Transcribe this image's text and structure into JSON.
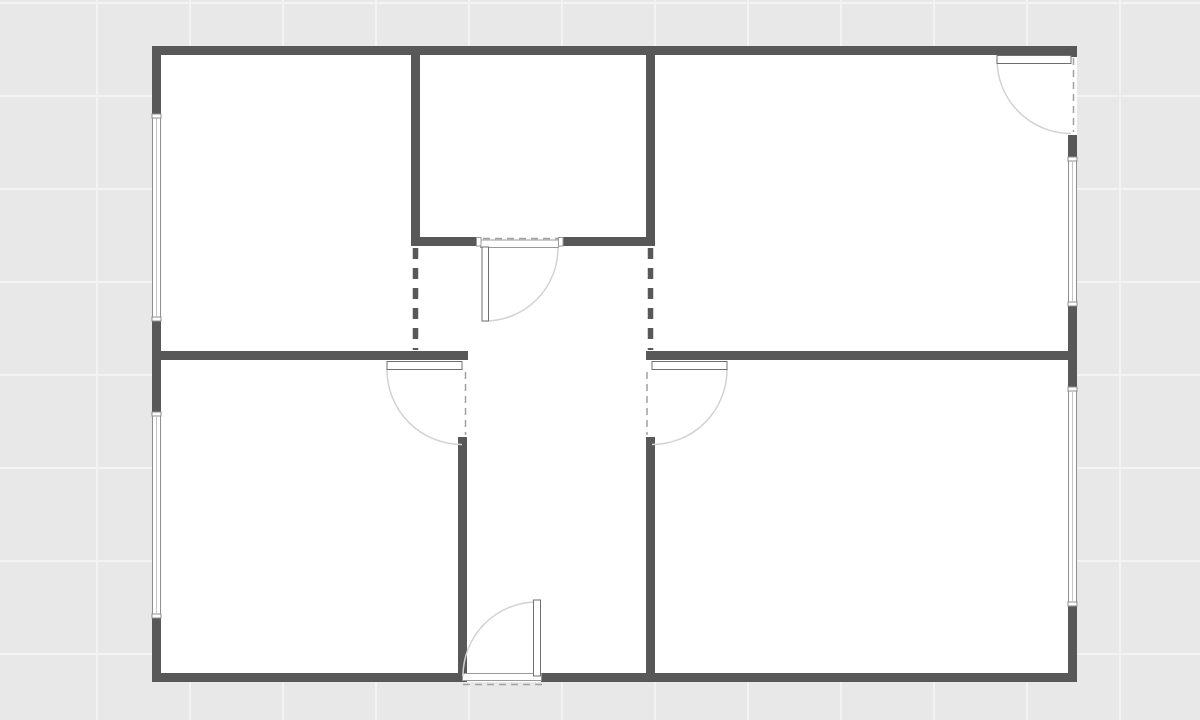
{
  "app": {
    "type": "floorplan-canvas",
    "title": "Floor plan canvas"
  },
  "canvas": {
    "width": 1200,
    "height": 720,
    "background": "#e8e8e8",
    "grid": {
      "spacing": 93,
      "offset_x": 97,
      "offset_y": 3,
      "color": "#f3f3f3",
      "line_width": 2
    }
  },
  "palette": {
    "wall": "#585858",
    "floor": "#ffffff",
    "window_stroke": "#8f8f8f",
    "window_glass": "#c4c4c4",
    "frame_stroke": "#9a9a9a",
    "leaf_fill": "#ffffff",
    "leaf_stroke": "#6f6f6f",
    "arc": "#d2d2d2",
    "dash_light": "#a0a0a0",
    "dash_heavy": "#585858"
  },
  "floorplan": {
    "floor": {
      "x": 152,
      "y": 46,
      "w": 925,
      "h": 636
    },
    "walls": [
      {
        "name": "exterior-top",
        "x": 152,
        "y": 46,
        "w": 925,
        "h": 9
      },
      {
        "name": "exterior-bottom-left",
        "x": 152,
        "y": 673,
        "w": 315,
        "h": 9
      },
      {
        "name": "exterior-bottom-right",
        "x": 541,
        "y": 673,
        "w": 536,
        "h": 9
      },
      {
        "name": "exterior-left-upper",
        "x": 152,
        "y": 46,
        "w": 9,
        "h": 69
      },
      {
        "name": "exterior-left-middle",
        "x": 152,
        "y": 320,
        "w": 9,
        "h": 93
      },
      {
        "name": "exterior-left-lower",
        "x": 152,
        "y": 617,
        "w": 9,
        "h": 65
      },
      {
        "name": "exterior-right-stub",
        "x": 1068,
        "y": 46,
        "w": 9,
        "h": 11
      },
      {
        "name": "exterior-right-upper",
        "x": 1068,
        "y": 135,
        "w": 9,
        "h": 23
      },
      {
        "name": "exterior-right-middle",
        "x": 1068,
        "y": 305,
        "w": 9,
        "h": 83
      },
      {
        "name": "exterior-right-lower",
        "x": 1068,
        "y": 605,
        "w": 9,
        "h": 77
      },
      {
        "name": "top-room-left",
        "x": 411,
        "y": 55,
        "w": 9,
        "h": 190
      },
      {
        "name": "top-room-right",
        "x": 646,
        "y": 55,
        "w": 9,
        "h": 190
      },
      {
        "name": "top-room-bottom-left",
        "x": 411,
        "y": 237,
        "w": 70,
        "h": 9
      },
      {
        "name": "top-room-bottom-right",
        "x": 562,
        "y": 237,
        "w": 93,
        "h": 9
      },
      {
        "name": "mid-wall-left",
        "x": 152,
        "y": 351,
        "w": 316,
        "h": 9
      },
      {
        "name": "mid-wall-right",
        "x": 646,
        "y": 351,
        "w": 422,
        "h": 9
      },
      {
        "name": "hallway-left",
        "x": 458,
        "y": 437,
        "w": 9,
        "h": 236
      },
      {
        "name": "hallway-right",
        "x": 646,
        "y": 437,
        "w": 9,
        "h": 236
      }
    ],
    "windows": [
      {
        "name": "window-left-upper",
        "x": 152.5,
        "y": 115,
        "w": 8,
        "h": 205
      },
      {
        "name": "window-left-lower",
        "x": 152.5,
        "y": 413,
        "w": 8,
        "h": 204
      },
      {
        "name": "window-right-upper",
        "x": 1068.5,
        "y": 158,
        "w": 8,
        "h": 147
      },
      {
        "name": "window-right-lower",
        "x": 1068.5,
        "y": 388,
        "w": 8,
        "h": 217
      }
    ],
    "sills": [
      {
        "name": "sill-top-room-door",
        "x": 480.5,
        "y": 240,
        "w": 78,
        "h": 7.5
      },
      {
        "name": "sill-entry-door",
        "x": 462.5,
        "y": 673.5,
        "w": 79,
        "h": 7
      }
    ],
    "jambs": [
      {
        "name": "jamb-top-room-left",
        "x": 476.5,
        "y": 237.5,
        "w": 4.5,
        "h": 8.5
      },
      {
        "name": "jamb-top-room-right",
        "x": 558.5,
        "y": 237.5,
        "w": 4.5,
        "h": 8.5
      }
    ],
    "door_leaves": [
      {
        "name": "door-leaf-top-room",
        "x": 482,
        "y": 247,
        "w": 6.5,
        "h": 74
      },
      {
        "name": "door-leaf-left-room",
        "x": 387,
        "y": 361.5,
        "w": 75,
        "h": 8
      },
      {
        "name": "door-leaf-right-room",
        "x": 652,
        "y": 361.5,
        "w": 75,
        "h": 8
      },
      {
        "name": "door-leaf-entry",
        "x": 533.5,
        "y": 600,
        "w": 7,
        "h": 76
      },
      {
        "name": "door-leaf-exterior-top",
        "x": 997,
        "y": 55.5,
        "w": 74,
        "h": 8
      }
    ],
    "door_arcs": [
      {
        "name": "door-arc-top-room",
        "cx": 485,
        "cy": 248,
        "r": 73,
        "from": 90,
        "to": 0,
        "sweep": 0
      },
      {
        "name": "door-arc-left-room",
        "cx": 462,
        "cy": 369.5,
        "r": 75,
        "from": 180,
        "to": 90,
        "sweep": 0
      },
      {
        "name": "door-arc-right-room",
        "cx": 652,
        "cy": 369.5,
        "r": 75,
        "from": 0,
        "to": 90,
        "sweep": 1
      },
      {
        "name": "door-arc-entry",
        "cx": 537,
        "cy": 676,
        "r": 74,
        "from": 270,
        "to": 180,
        "sweep": 0
      },
      {
        "name": "door-arc-exterior-top",
        "cx": 1071,
        "cy": 59.5,
        "r": 74,
        "from": 180,
        "to": 90,
        "sweep": 0
      }
    ],
    "door_swing_dashes": [
      {
        "name": "door-closed-top-room",
        "x1": 483,
        "y1": 238.5,
        "x2": 558,
        "y2": 238.5
      },
      {
        "name": "door-closed-left-room",
        "x1": 465.5,
        "y1": 372,
        "x2": 465.5,
        "y2": 435
      },
      {
        "name": "door-closed-right-room",
        "x1": 647,
        "y1": 372,
        "x2": 647,
        "y2": 435
      },
      {
        "name": "door-closed-entry",
        "x1": 463,
        "y1": 684.5,
        "x2": 546,
        "y2": 684.5
      },
      {
        "name": "door-closed-exterior-top",
        "x1": 1073.5,
        "y1": 58,
        "x2": 1073.5,
        "y2": 132
      }
    ],
    "wall_openings_dashed": [
      {
        "name": "opening-hallway-left",
        "x1": 415.5,
        "y1": 248,
        "x2": 415.5,
        "y2": 350
      },
      {
        "name": "opening-hallway-right",
        "x1": 650.5,
        "y1": 248,
        "x2": 650.5,
        "y2": 350
      }
    ]
  }
}
